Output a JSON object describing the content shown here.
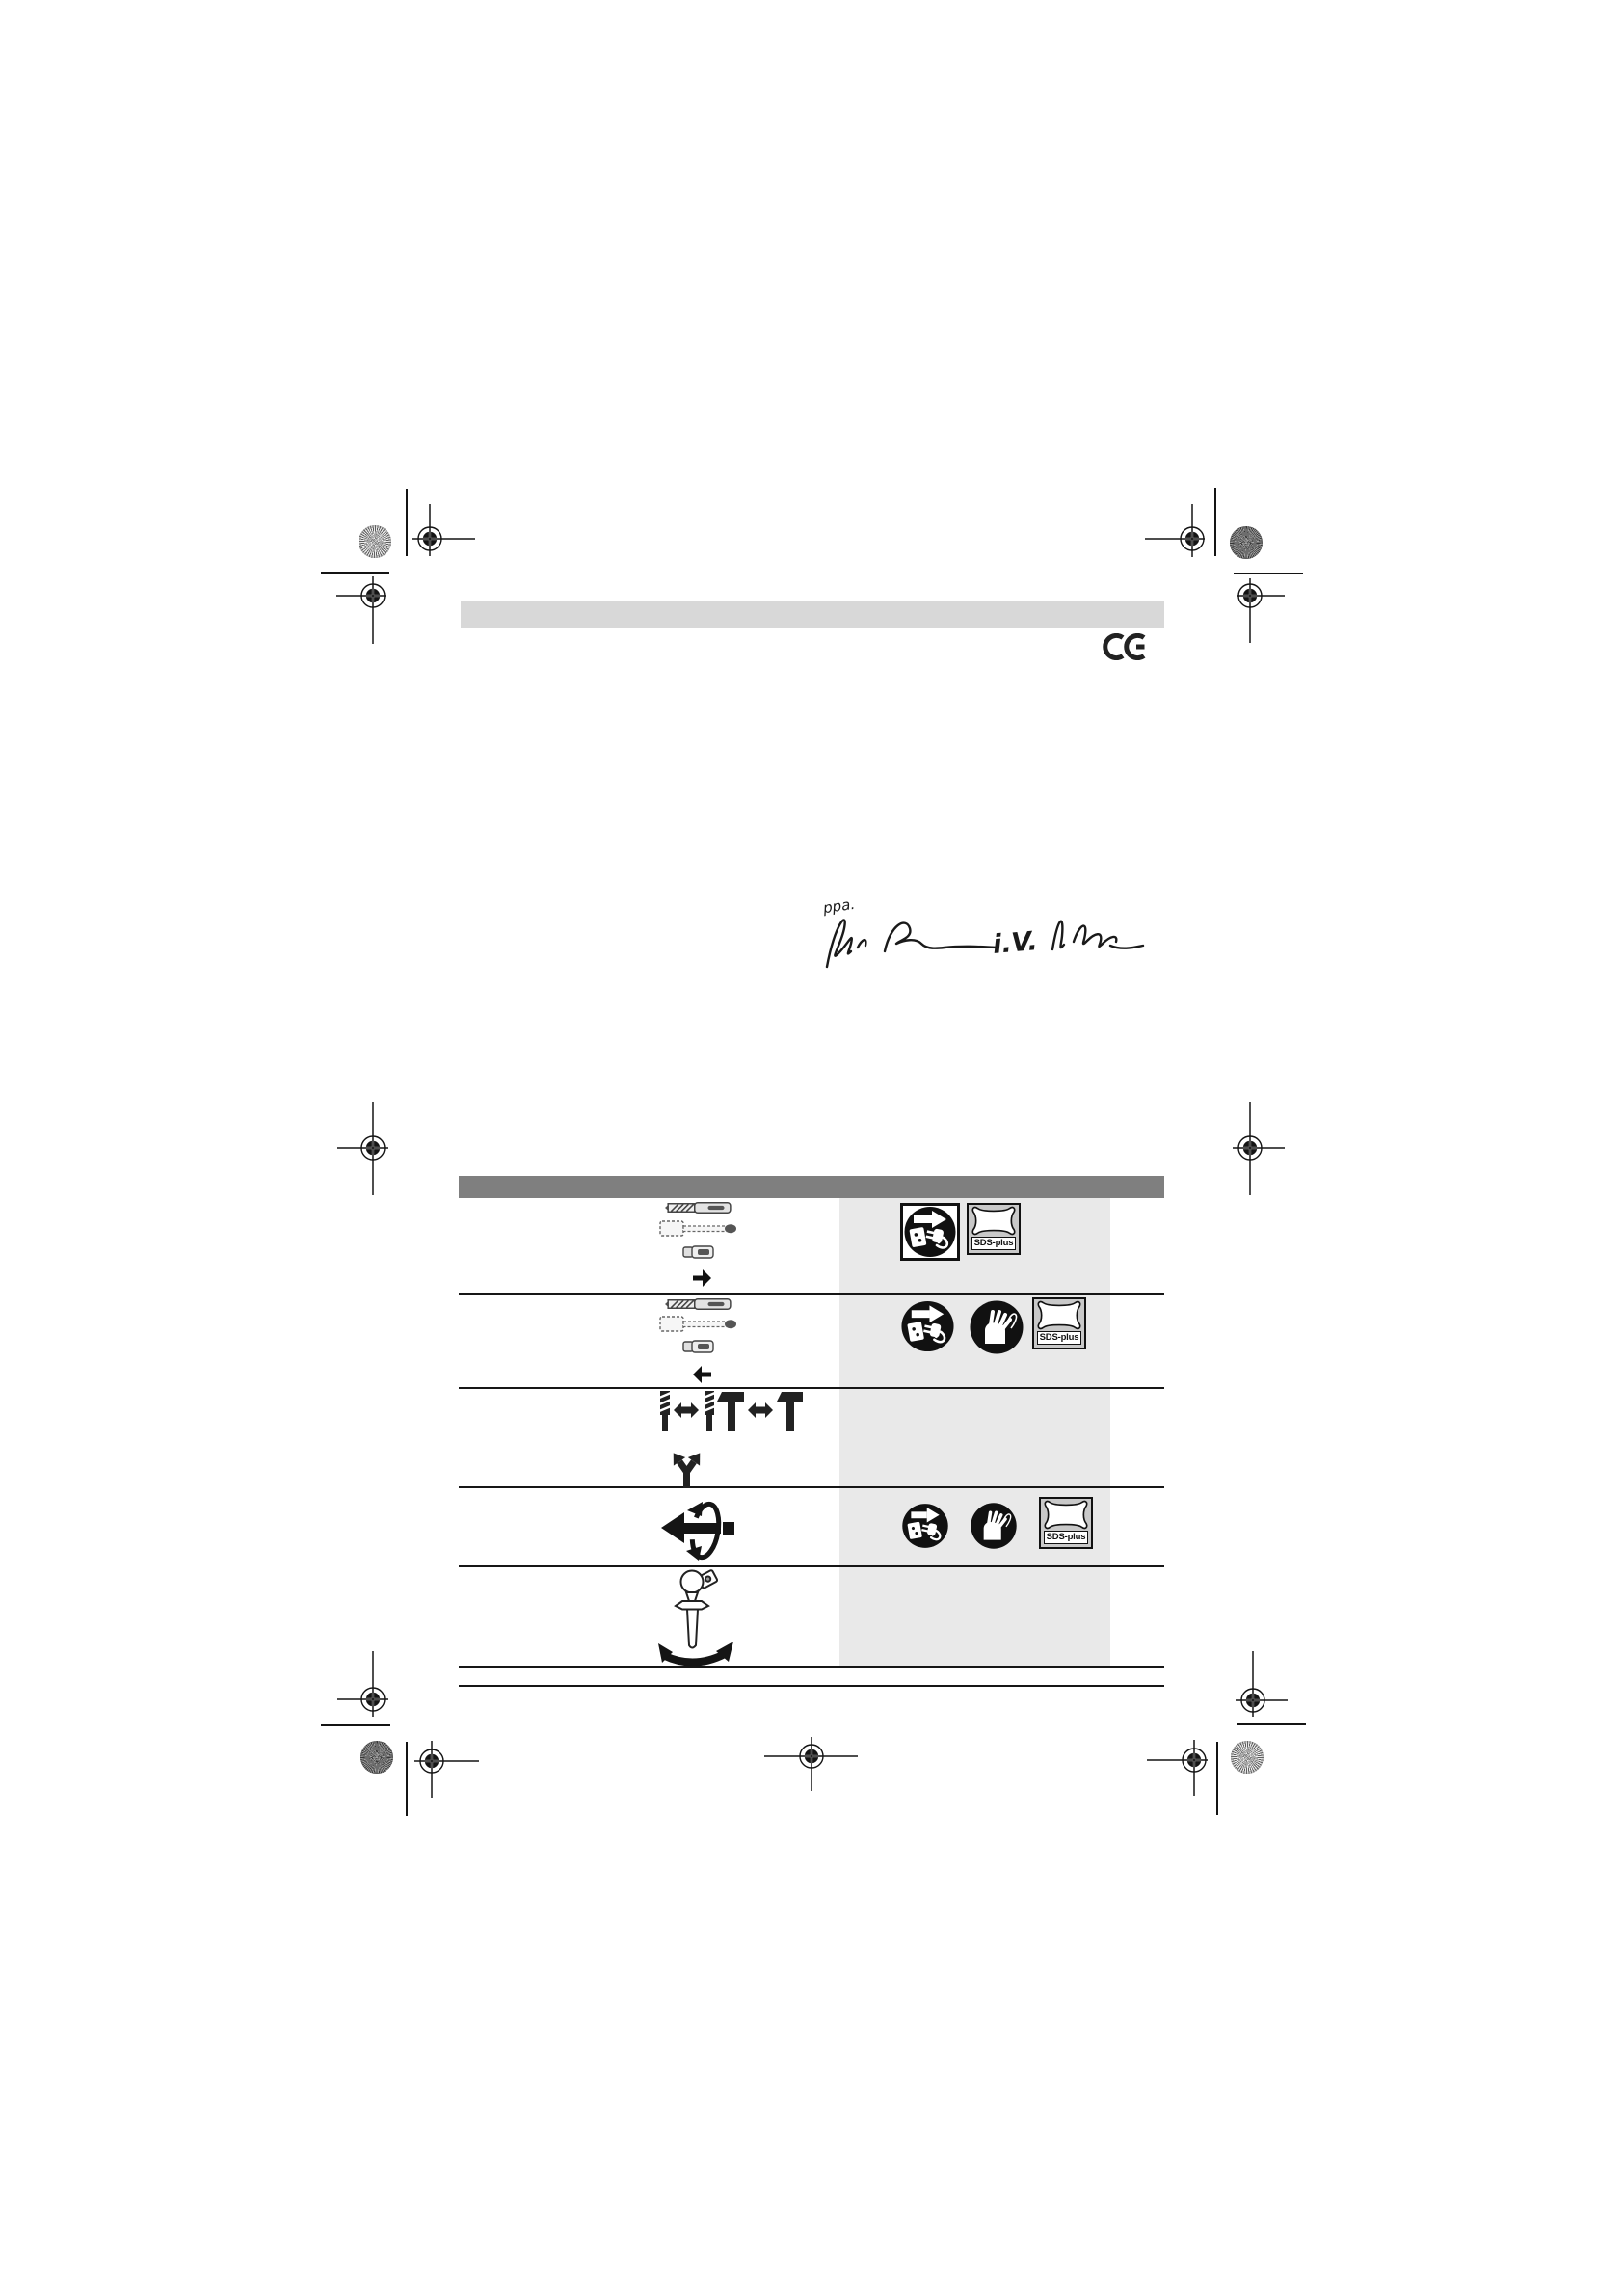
{
  "page": {
    "kind": "printed-instruction-manual-page",
    "background": "#ffffff"
  },
  "decoration": {
    "top_bar_color": "#d8d8d8",
    "table_header_color": "#7f7f7f",
    "table_panel_color": "#e9e9e9",
    "line_color": "#141414"
  },
  "ce_mark": {
    "label": "CE"
  },
  "signatures": {
    "left_prefix": "ppa.",
    "right_prefix": "i.V."
  },
  "table": {
    "rows": [
      {
        "id": "insert-sds-plus-accessory",
        "pictograms": [
          "sds-drill-bit",
          "flat-chisel",
          "adapter-bit",
          "arrow-right"
        ],
        "icons": [
          {
            "name": "unplug-power-icon-boxed"
          },
          {
            "name": "sds-plus-clamping-icon",
            "label": "SDS-plus"
          }
        ]
      },
      {
        "id": "remove-sds-plus-accessory",
        "pictograms": [
          "sds-drill-bit",
          "flat-chisel",
          "adapter-bit",
          "arrow-left"
        ],
        "icons": [
          {
            "name": "unplug-power-icon"
          },
          {
            "name": "wear-gloves-icon"
          },
          {
            "name": "sds-plus-clamping-icon",
            "label": "SDS-plus"
          }
        ]
      },
      {
        "id": "tool-change",
        "pictograms": [
          "drill-bit-swap-t-handle",
          "diverging-arrows"
        ],
        "icons": []
      },
      {
        "id": "chisel-position-rotation",
        "pictograms": [
          "shaft-rotation-arrow"
        ],
        "icons": [
          {
            "name": "unplug-power-icon"
          },
          {
            "name": "wear-gloves-icon"
          },
          {
            "name": "sds-plus-clamping-icon",
            "label": "SDS-plus"
          }
        ]
      },
      {
        "id": "auxiliary-handle-swivel",
        "pictograms": [
          "auxiliary-handle",
          "swivel-arc-arrow"
        ],
        "icons": []
      }
    ]
  }
}
